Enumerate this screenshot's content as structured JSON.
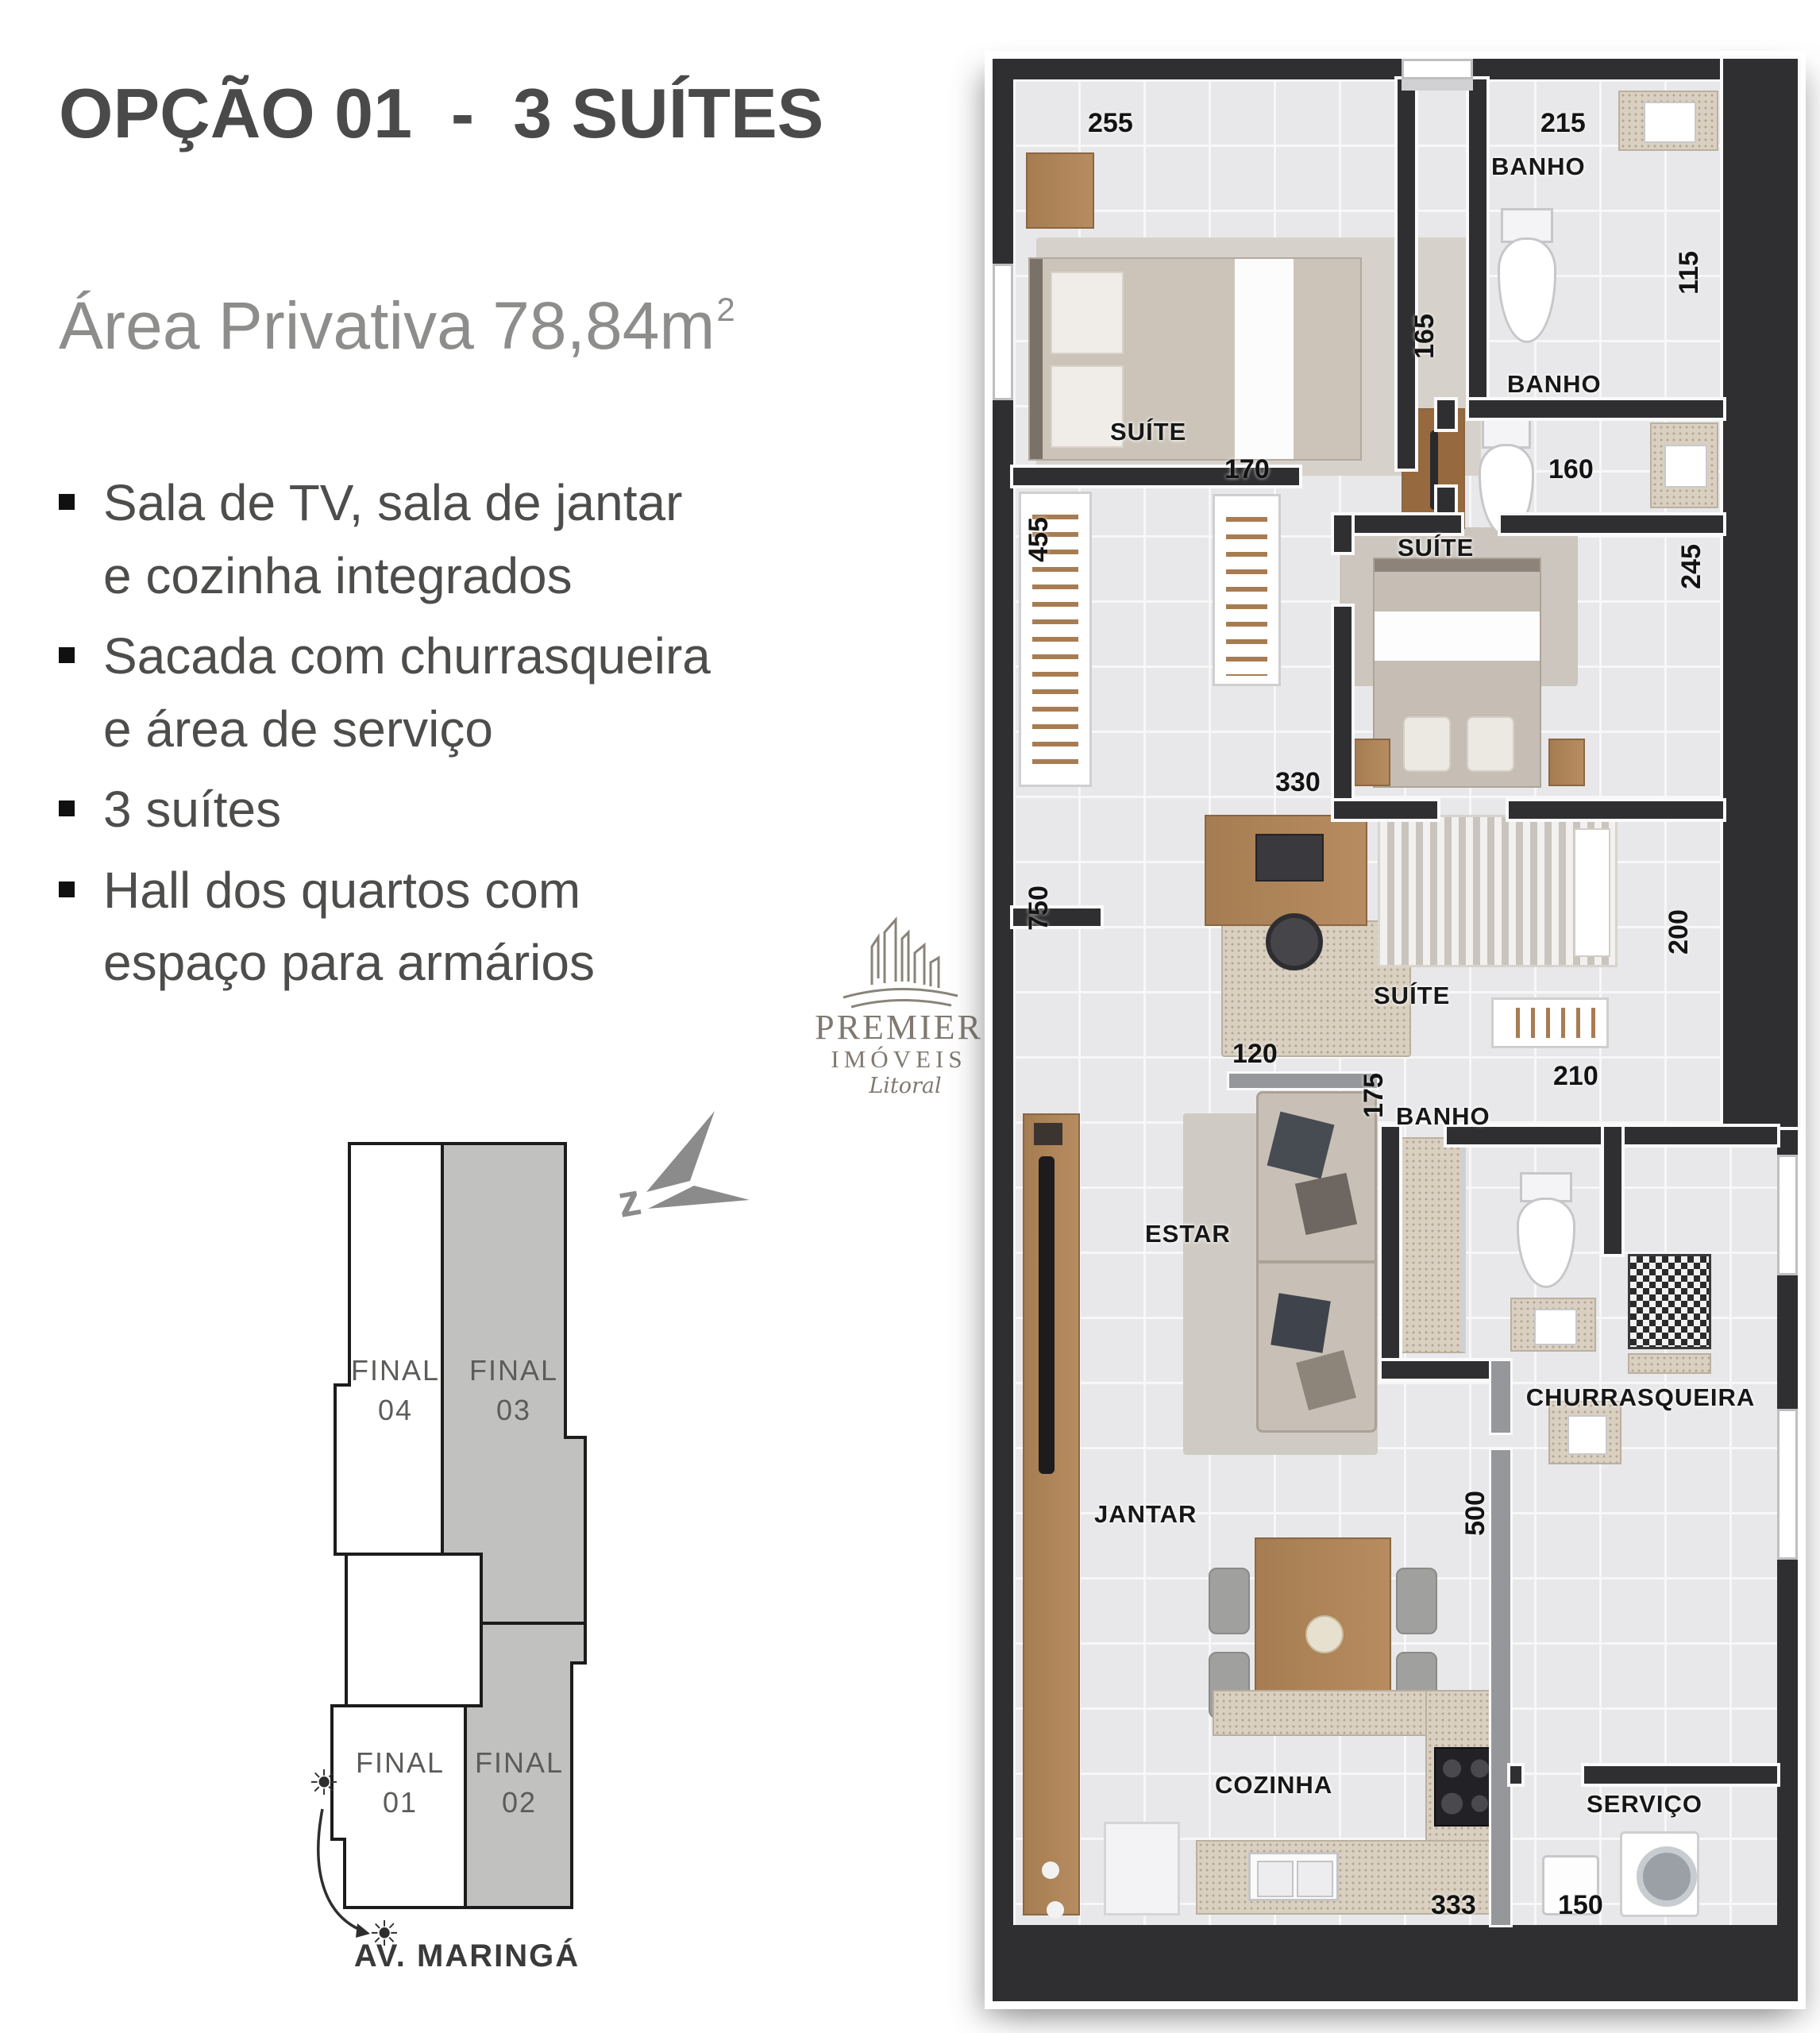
{
  "left_panel": {
    "title": "OPÇÃO 01  -  3 SUÍTES",
    "area_text": "Área Privativa 78,84m",
    "area_superscript": "2",
    "bullets": [
      "Sala de TV, sala de jantar\ne cozinha integrados",
      "Sacada com churrasqueira\ne área de serviço",
      "3 suítes",
      "Hall dos quartos com\nespaço para armários"
    ],
    "logo": {
      "brand_top": "PREMIER",
      "brand_bottom": "IMÓVEIS",
      "brand_script": "Litoral"
    },
    "footprint": {
      "units": [
        {
          "l1": "FINAL",
          "l2": "04"
        },
        {
          "l1": "FINAL",
          "l2": "03"
        },
        {
          "l1": "FINAL",
          "l2": "01"
        },
        {
          "l1": "FINAL",
          "l2": "02"
        }
      ],
      "street": "AV. MARINGÁ",
      "sun_icon": "☀"
    },
    "compass_letter": "z"
  },
  "floorplan": {
    "labels": {
      "suite": "SUÍTE",
      "banho": "BANHO",
      "estar": "ESTAR",
      "jantar": "JANTAR",
      "cozinha": "COZINHA",
      "churrasqueira": "CHURRASQUEIRA",
      "servico": "SERVIÇO"
    },
    "dims": {
      "d255": "255",
      "d215": "215",
      "d115": "115",
      "d165": "165",
      "d160": "160",
      "d245": "245",
      "d455": "455",
      "d170": "170",
      "d330": "330",
      "d750": "750",
      "d200": "200",
      "d210": "210",
      "d120": "120",
      "d175": "175",
      "d500": "500",
      "d333": "333",
      "d150": "150"
    }
  },
  "colors": {
    "title_text": "#4a4a4a",
    "subtitle_text": "#8d8d8b",
    "wall": "#2f2f31",
    "floor_tile": "#e8e8ea",
    "wood": "#a67c52",
    "footprint_gray": "#c1c1bf",
    "logo_gray": "#7f7971"
  }
}
